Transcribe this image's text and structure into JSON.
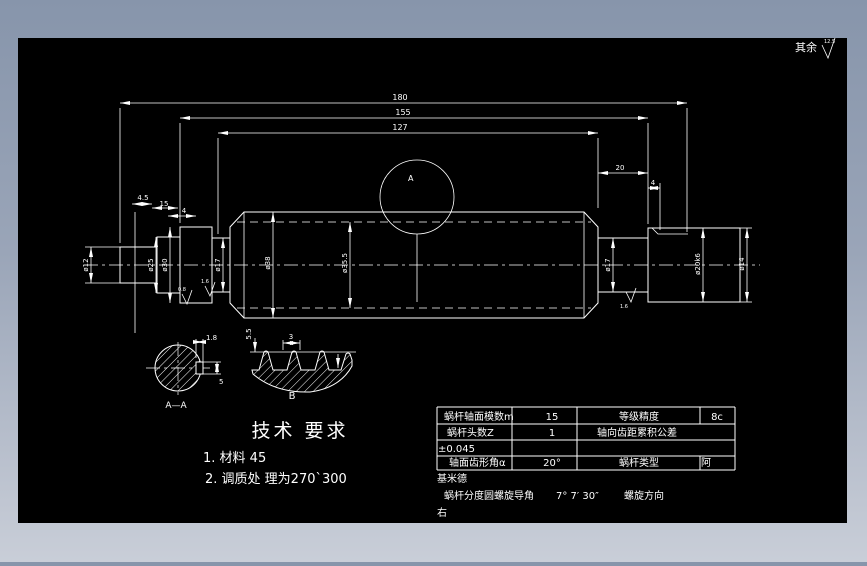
{
  "frame": {
    "background_top": "#8795ab",
    "background_bottom": "#c9ced8",
    "canvas_color": "#000000",
    "line_color": "#ffffff"
  },
  "surface_note": {
    "label": "其余",
    "value": "12.5"
  },
  "dims": {
    "len1": "180",
    "len2": "155",
    "len3": "127",
    "groove_w": "4.5",
    "step_w": "15",
    "neck_w_left": "4",
    "right_len": "20",
    "right_groove": "4",
    "dia_stub": "ø12",
    "dia_step": "ø25",
    "dia_flange": "ø30",
    "dia_neck_left": "ø17",
    "dia_worm_tip": "ø38",
    "dia_worm_root": "ø35.5",
    "dia_neck_right": "ø17",
    "dia_journal": "ø20k6",
    "dia_end": "ø14",
    "detail_label": "A",
    "rough1": "0.8",
    "rough2": "1.6",
    "rough3": "1.6"
  },
  "section_aa": {
    "label": "A—A",
    "key_depth": "1.8",
    "key_width": "5"
  },
  "detail_b": {
    "label": "B",
    "pitch": "3",
    "height": "5.5"
  },
  "tech": {
    "title": "技术 要求",
    "item1": "1. 材料   45",
    "item2": "2. 调质处 理为270`300"
  },
  "table": {
    "rows": [
      {
        "c1": "蜗杆轴面模数m",
        "c2": "15",
        "c3": "等级精度",
        "c4": "8c"
      },
      {
        "c1": "蜗杆头数Z",
        "c2": "1",
        "c3": "轴向齿距累积公差",
        "c4": ""
      },
      {
        "c1": "±0.045",
        "c2": "",
        "c3": "",
        "c4": ""
      },
      {
        "c1": "轴面齿形角α",
        "c2": "20°",
        "c3": "蜗杆类型",
        "c4": "阿"
      }
    ],
    "wrap": "基米德",
    "lead_label": "蜗杆分度圆螺旋导角",
    "lead_value": "7° 7′ 30″",
    "dir_label": "螺旋方向",
    "dir_value": "右"
  }
}
